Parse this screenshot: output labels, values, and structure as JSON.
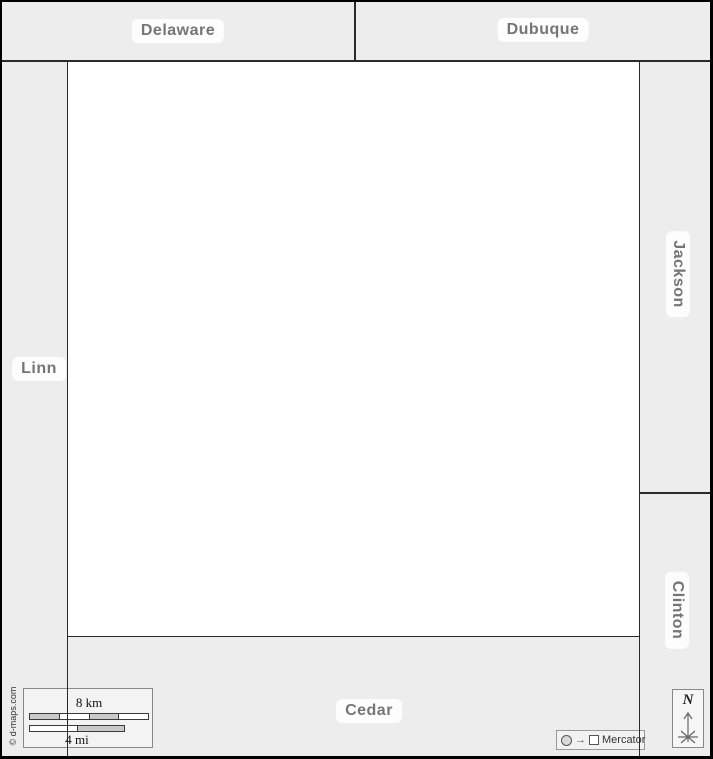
{
  "labels": {
    "delaware": "Delaware",
    "dubuque": "Dubuque",
    "jackson": "Jackson",
    "clinton": "Clinton",
    "linn": "Linn",
    "cedar": "Cedar"
  },
  "scale_bar": {
    "km": "8 km",
    "mi": "4 mi"
  },
  "attribution": "© d-maps.com",
  "projection": {
    "label": "Mercator",
    "arrow": "→"
  },
  "compass": {
    "north": "N"
  },
  "colors": {
    "neighbor_fill": "#ededed",
    "main_county_fill": "#ffffff",
    "boundary_line": "#2a2a2a",
    "label_text": "#757575",
    "scale_segment_gray": "#c9c9c9"
  }
}
